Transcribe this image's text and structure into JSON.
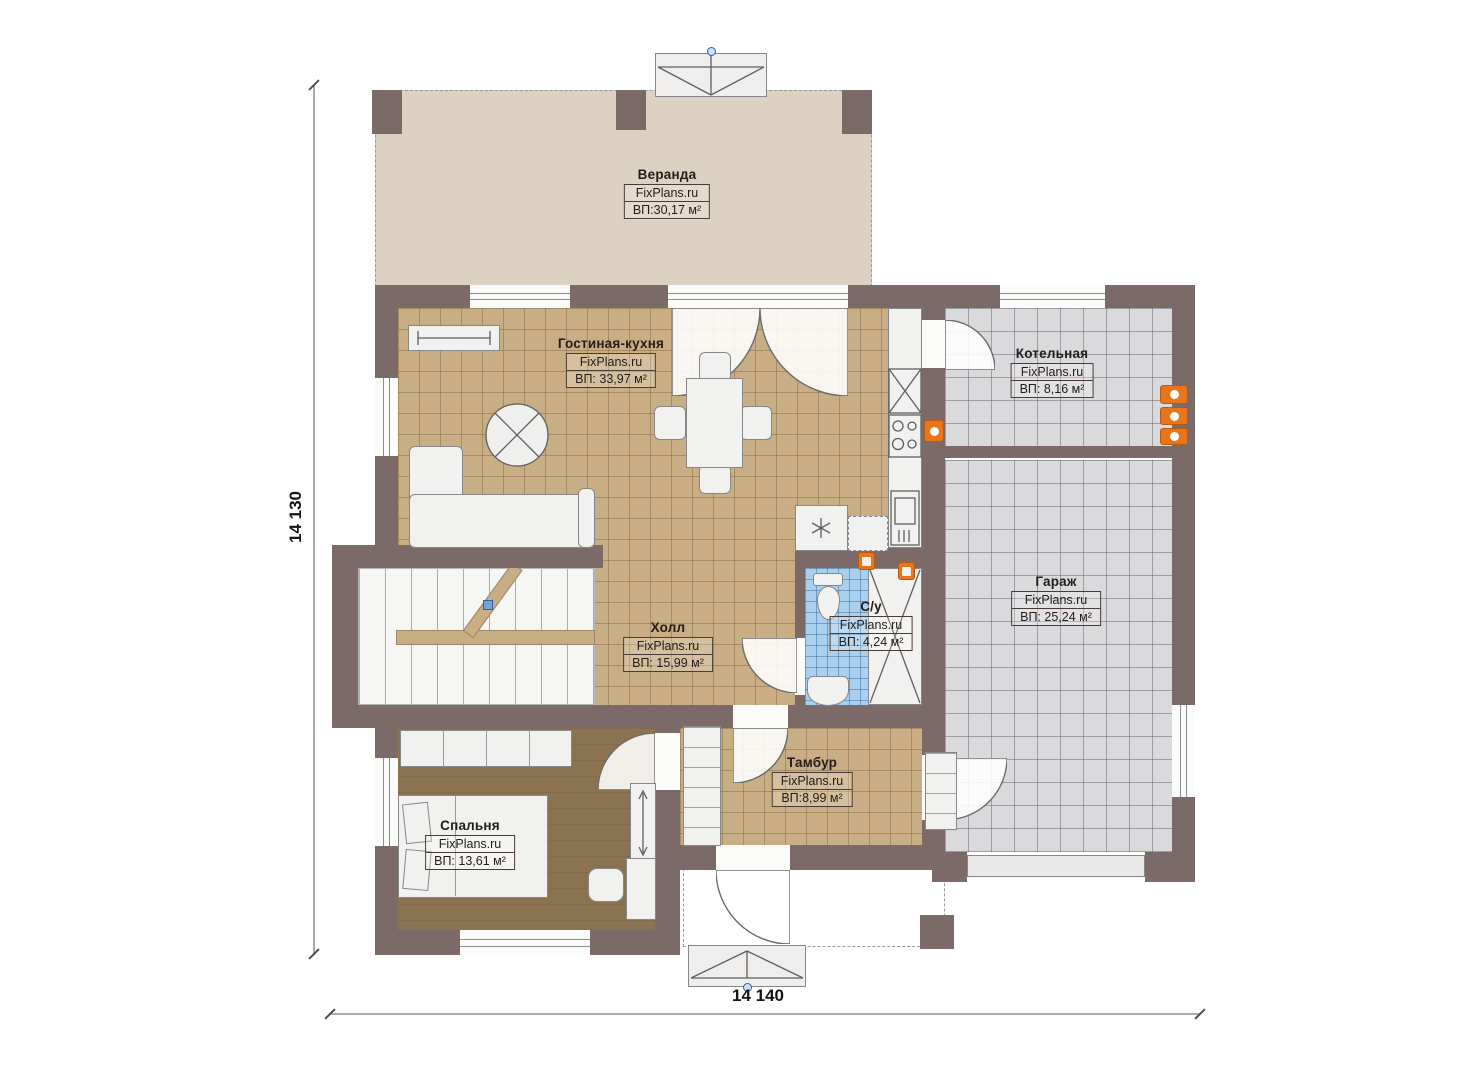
{
  "plan": {
    "brand_watermark": "FixPlans.ru",
    "dimensions": {
      "vertical_label": "14 130",
      "horizontal_label": "14 140"
    },
    "rooms": [
      {
        "id": "veranda",
        "name": "Веранда",
        "brand": "FixPlans.ru",
        "area": "ВП:30,17 м²"
      },
      {
        "id": "living",
        "name": "Гостиная-кухня",
        "brand": "FixPlans.ru",
        "area": "ВП: 33,97 м²"
      },
      {
        "id": "boiler",
        "name": "Котельная",
        "brand": "FixPlans.ru",
        "area": "ВП: 8,16 м²"
      },
      {
        "id": "garage",
        "name": "Гараж",
        "brand": "FixPlans.ru",
        "area": "ВП: 25,24 м²"
      },
      {
        "id": "hall",
        "name": "Холл",
        "brand": "FixPlans.ru",
        "area": "ВП: 15,99 м²"
      },
      {
        "id": "wc",
        "name": "С/у",
        "brand": "FixPlans.ru",
        "area": "ВП: 4,24 м²"
      },
      {
        "id": "tambour",
        "name": "Тамбур",
        "brand": "FixPlans.ru",
        "area": "ВП:8,99 м²"
      },
      {
        "id": "bedroom",
        "name": "Спальня",
        "brand": "FixPlans.ru",
        "area": "ВП: 13,61 м²"
      }
    ],
    "symbols": {
      "washer": "✳"
    },
    "colors": {
      "wall": "#7b6a68",
      "veranda_floor": "#ddd1c1",
      "tile_tan": "#c9ae85",
      "tile_grey": "#dadadd",
      "tile_blue": "#a9d0ef",
      "wood_floor": "#8b7352",
      "fixture": "#f1f1ef",
      "accent_orange": "#e8751b",
      "marker_blue": "#2b5fb0"
    }
  }
}
